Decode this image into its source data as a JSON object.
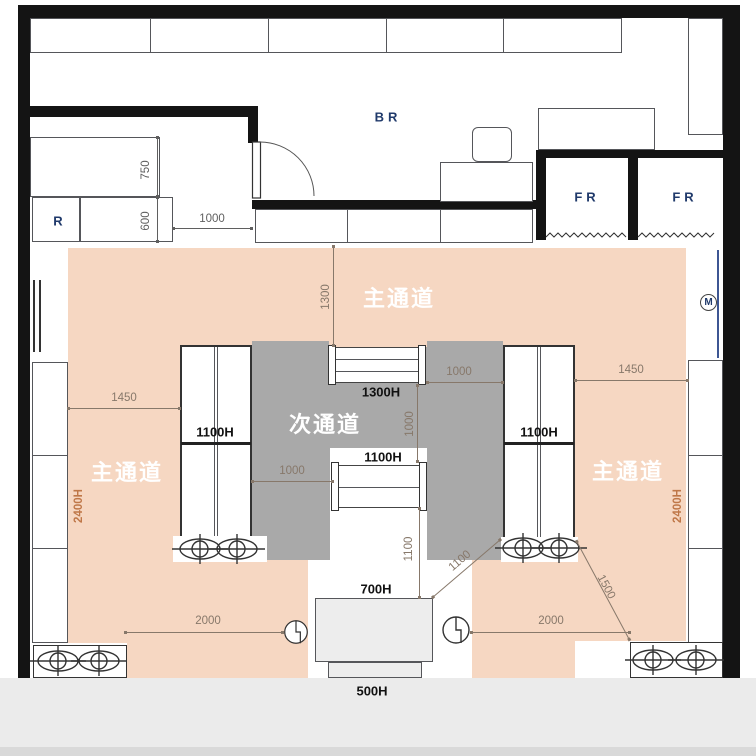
{
  "colors": {
    "main_aisle": "#f6d7c2",
    "sub_aisle": "#a9a9a9",
    "wall": "#141414",
    "room_label": "#203a6b",
    "dim_label": "#87786a",
    "height_label": "#bf7748"
  },
  "rooms": {
    "backroom": "BR",
    "freezer_left": "FR",
    "freezer_right": "FR",
    "register": "R",
    "meter_mark": "M"
  },
  "aisles": {
    "main_top": "主通道",
    "main_left": "主通道",
    "main_right": "主通道",
    "sub_center": "次通道"
  },
  "fixture_heights": {
    "gondola_left": "1100H",
    "gondola_right": "1100H",
    "island_top": "1300H",
    "island_bottom": "1100H",
    "service_counter": "700H",
    "counter_front": "500H",
    "wall_shelf_left": "2400H",
    "wall_shelf_right": "2400H"
  },
  "dimensions": {
    "register_upper": "750",
    "register_lower": "600",
    "register_gap": "1000",
    "top_aisle": "1300",
    "left_gap": "1450",
    "right_gap": "1450",
    "sub_aisle_left": "1000",
    "sub_aisle_right": "1000",
    "island_gap": "1000",
    "counter_clearance": "1100",
    "diag_counter": "1100",
    "diag_exit": "1500",
    "front_left": "2000",
    "front_right": "2000"
  }
}
